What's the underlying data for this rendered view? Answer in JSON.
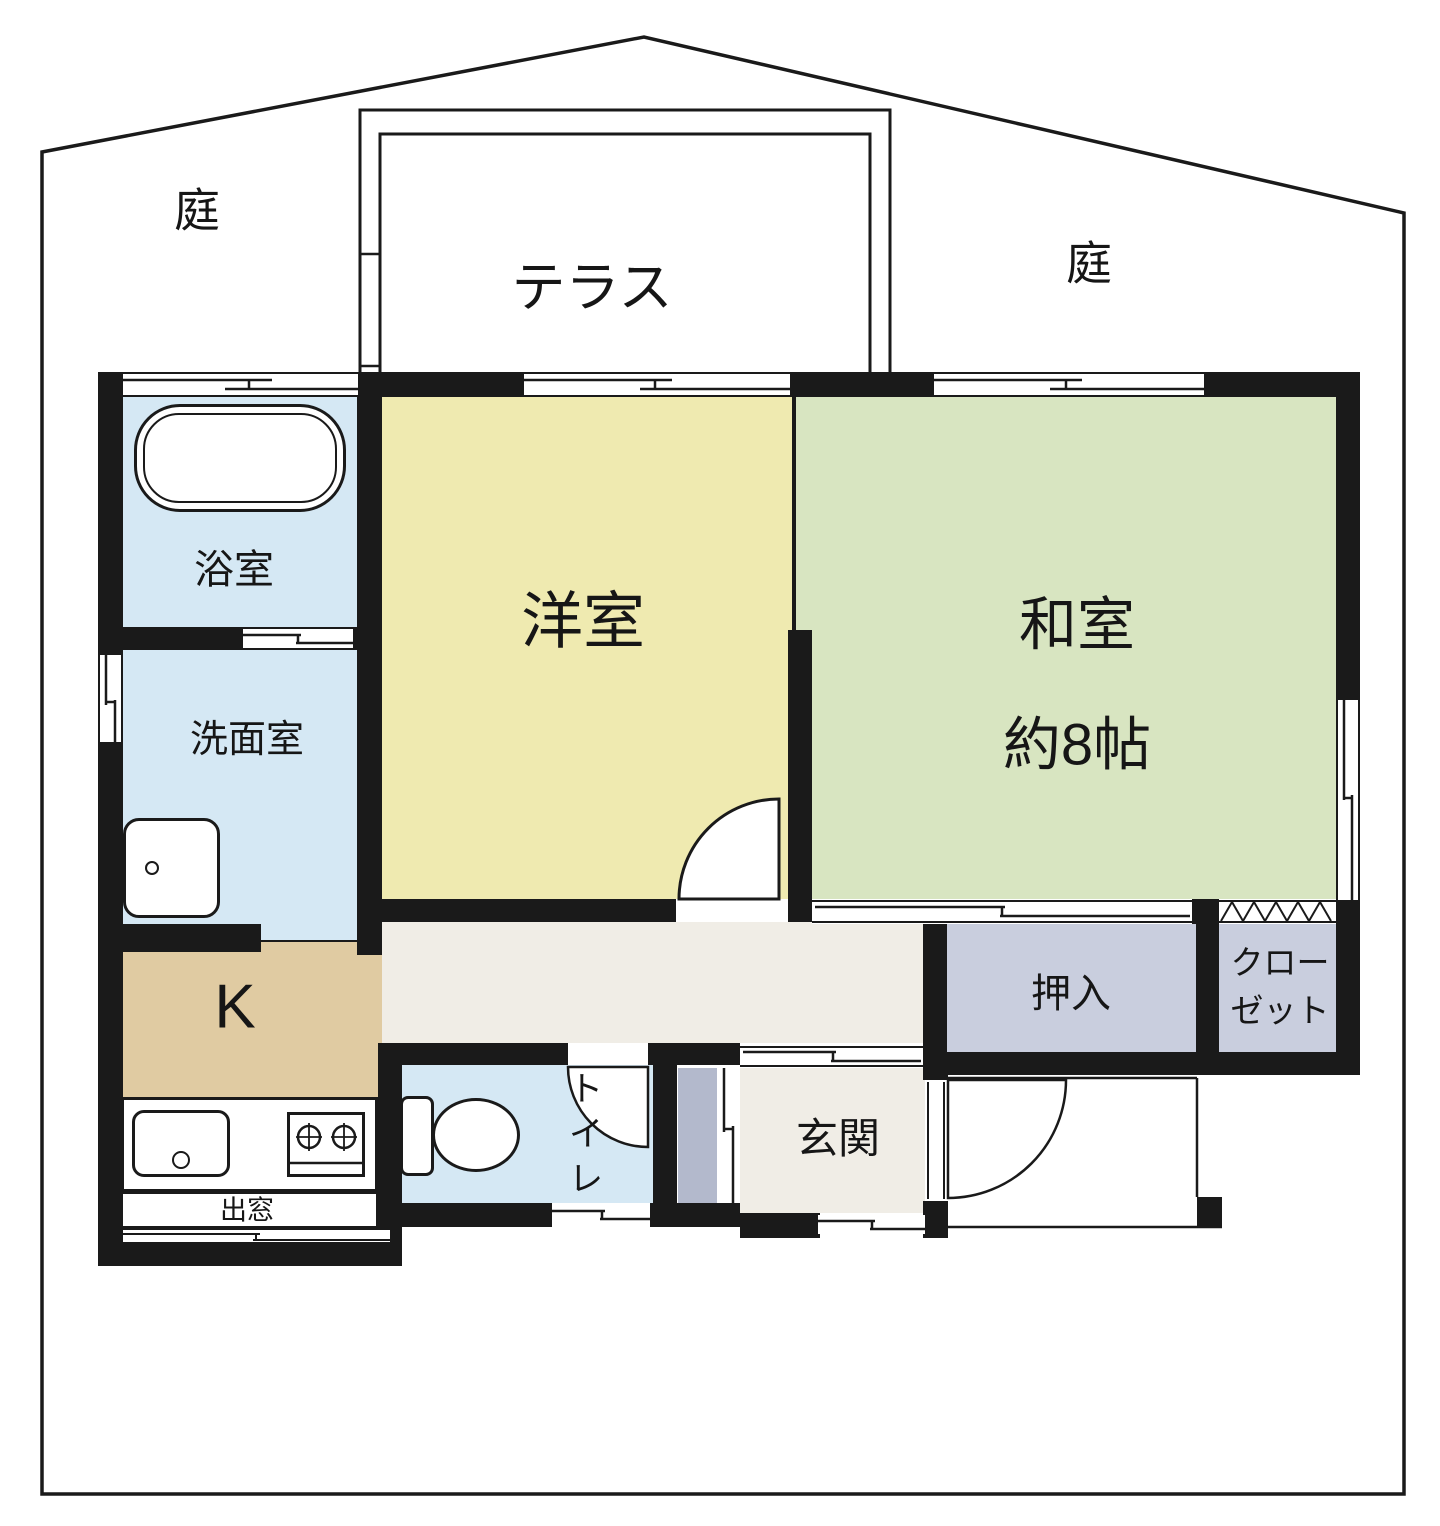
{
  "labels": {
    "garden_left": "庭",
    "garden_right": "庭",
    "terrace": "テラス",
    "bathroom": "浴室",
    "washroom": "洗面室",
    "western_room": "洋室",
    "japanese_room": "和室",
    "japanese_room_size": "約8帖",
    "kitchen": "K",
    "bay_window": "出窓",
    "toilet": [
      "ト",
      "イ",
      "レ"
    ],
    "entrance": "玄関",
    "oshiire": "押入",
    "closet": [
      "クロー",
      "ゼット"
    ]
  },
  "colors": {
    "wall": "#1a1a1a",
    "water_blue": "#d5e8f4",
    "room_yellow": "#efeab0",
    "tatami_green": "#d8e5c1",
    "kitchen_tan": "#e0cba2",
    "hall_cream": "#f0ede6",
    "storage_grey": "#c9cede",
    "cabinet_grey": "#b3b9cc",
    "background": "#ffffff"
  }
}
